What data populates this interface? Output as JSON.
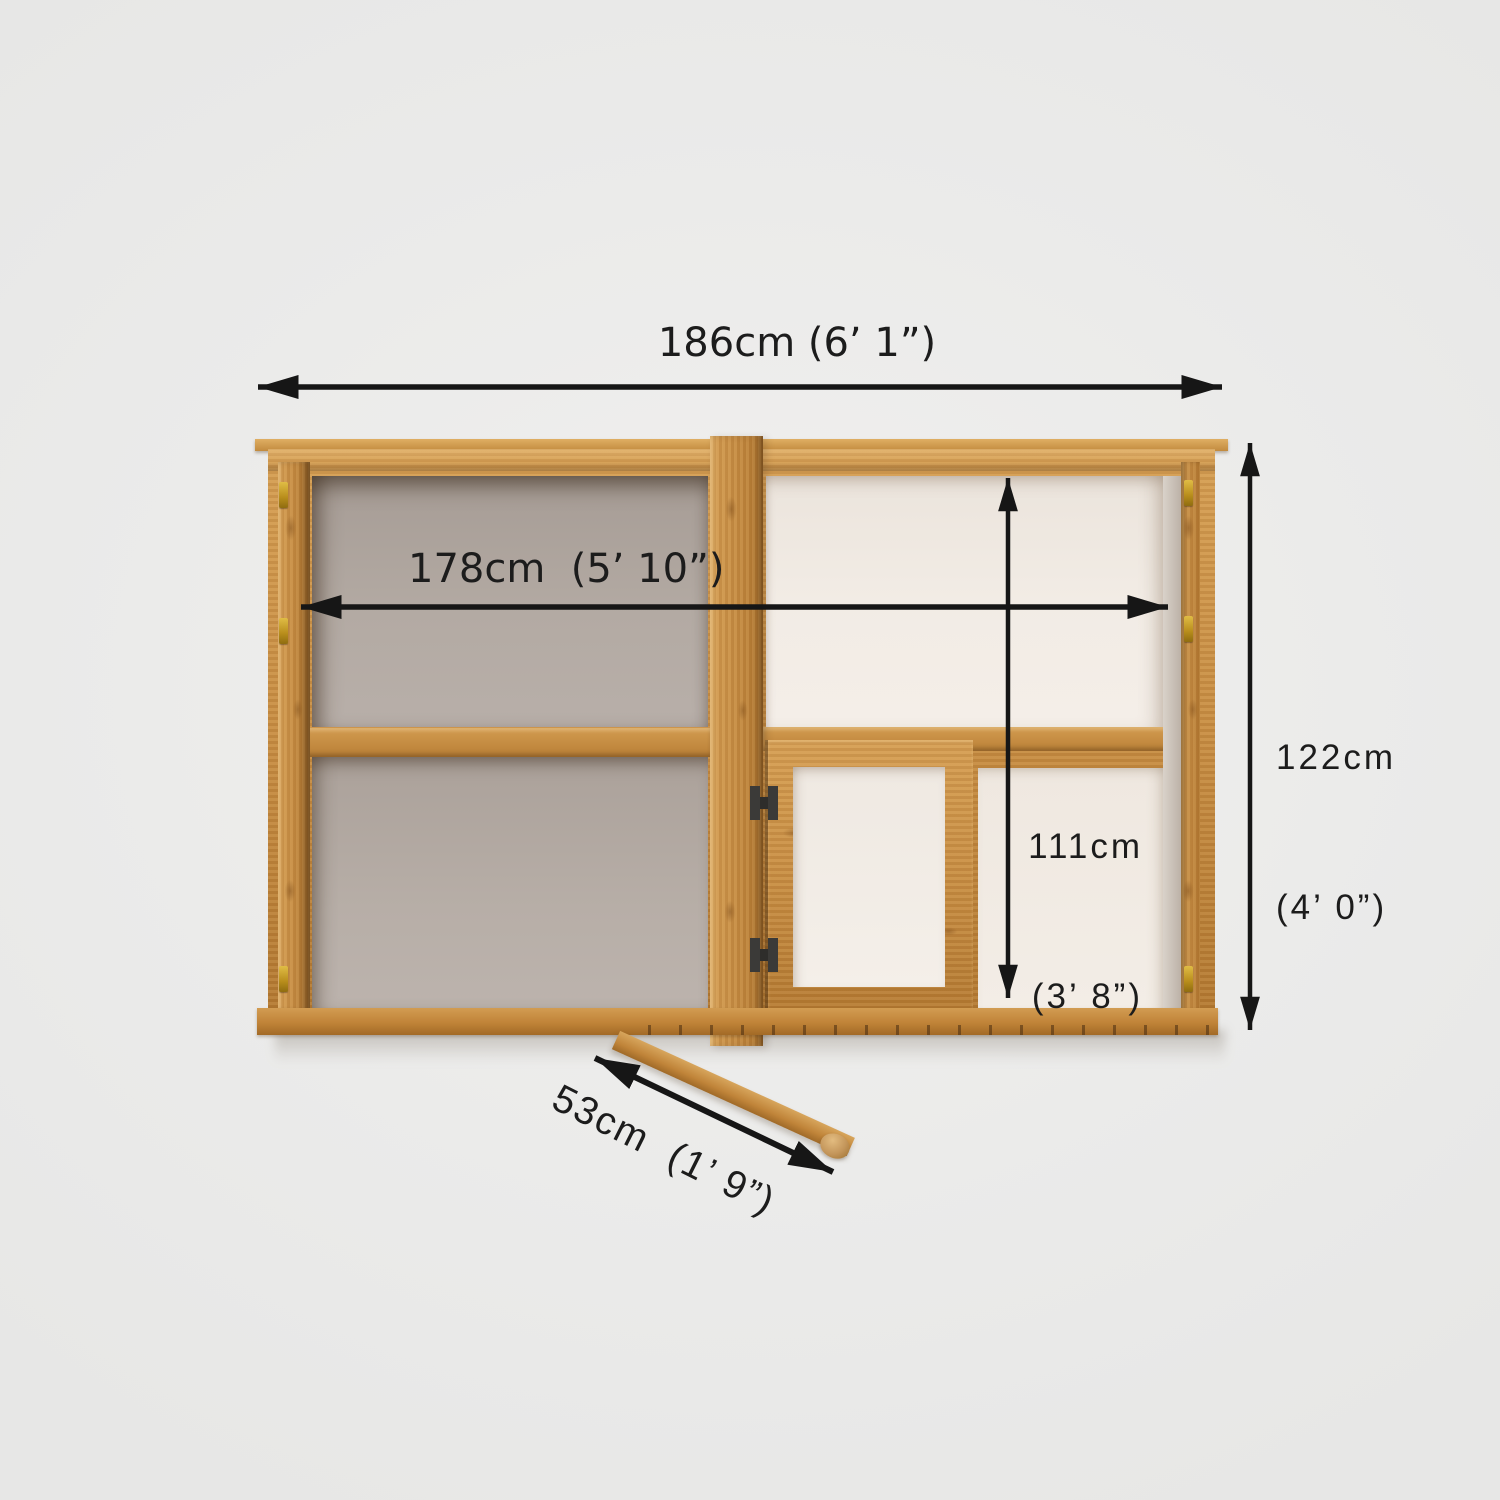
{
  "diagram": {
    "labels": {
      "total_width": "186cm (6’ 1”)",
      "internal_width": "178cm  (5’ 10”)",
      "total_height_line1": "122cm",
      "total_height_line2": "(4’ 0”)",
      "internal_height_line1": "111cm",
      "internal_height_line2": "(3’ 8”)",
      "door_opening": "53cm  (1’ 9”)"
    },
    "colors": {
      "background": "#ebebea",
      "wood": "#c68c42",
      "wood_light": "#d49d52",
      "wood_dark": "#a26a26",
      "glazing_left_panel": "#b3aaa3",
      "glazing_right_panel": "#f2ece5",
      "arrow": "#161616",
      "brass_clip": "#c89d2a",
      "door_hinge": "#3b3a38"
    }
  }
}
